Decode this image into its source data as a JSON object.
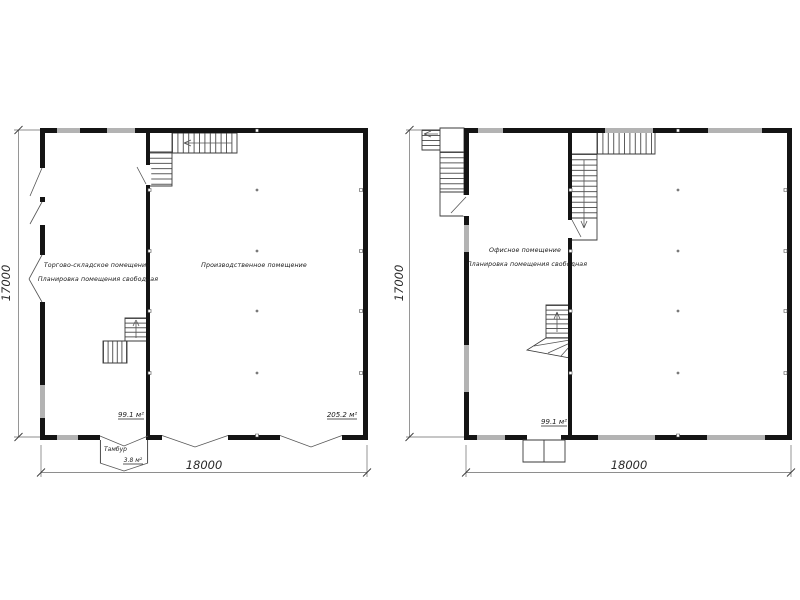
{
  "drawing_title": "Floor plans 18000 x 17000",
  "colors": {
    "wall": "#141414",
    "window": "#b3b3b3",
    "text": "#1a1a1a"
  },
  "plan1": {
    "room1": {
      "name_line1": "Торгово-складское помещение",
      "name_line2": "Планировка помещения свободная",
      "area": "99.1 м²"
    },
    "room2": {
      "name": "Производственное помещение",
      "area": "205.2 м²"
    },
    "tambour": {
      "name": "Тамбур",
      "area": "3.8 м²"
    },
    "dimensions": {
      "width": "18000",
      "height": "17000"
    }
  },
  "plan2": {
    "room1": {
      "name_line1": "Офисное помещение",
      "name_line2": "Планировка помещения свободная",
      "area": "99.1 м²"
    },
    "dimensions": {
      "width": "18000",
      "height": "17000"
    }
  }
}
